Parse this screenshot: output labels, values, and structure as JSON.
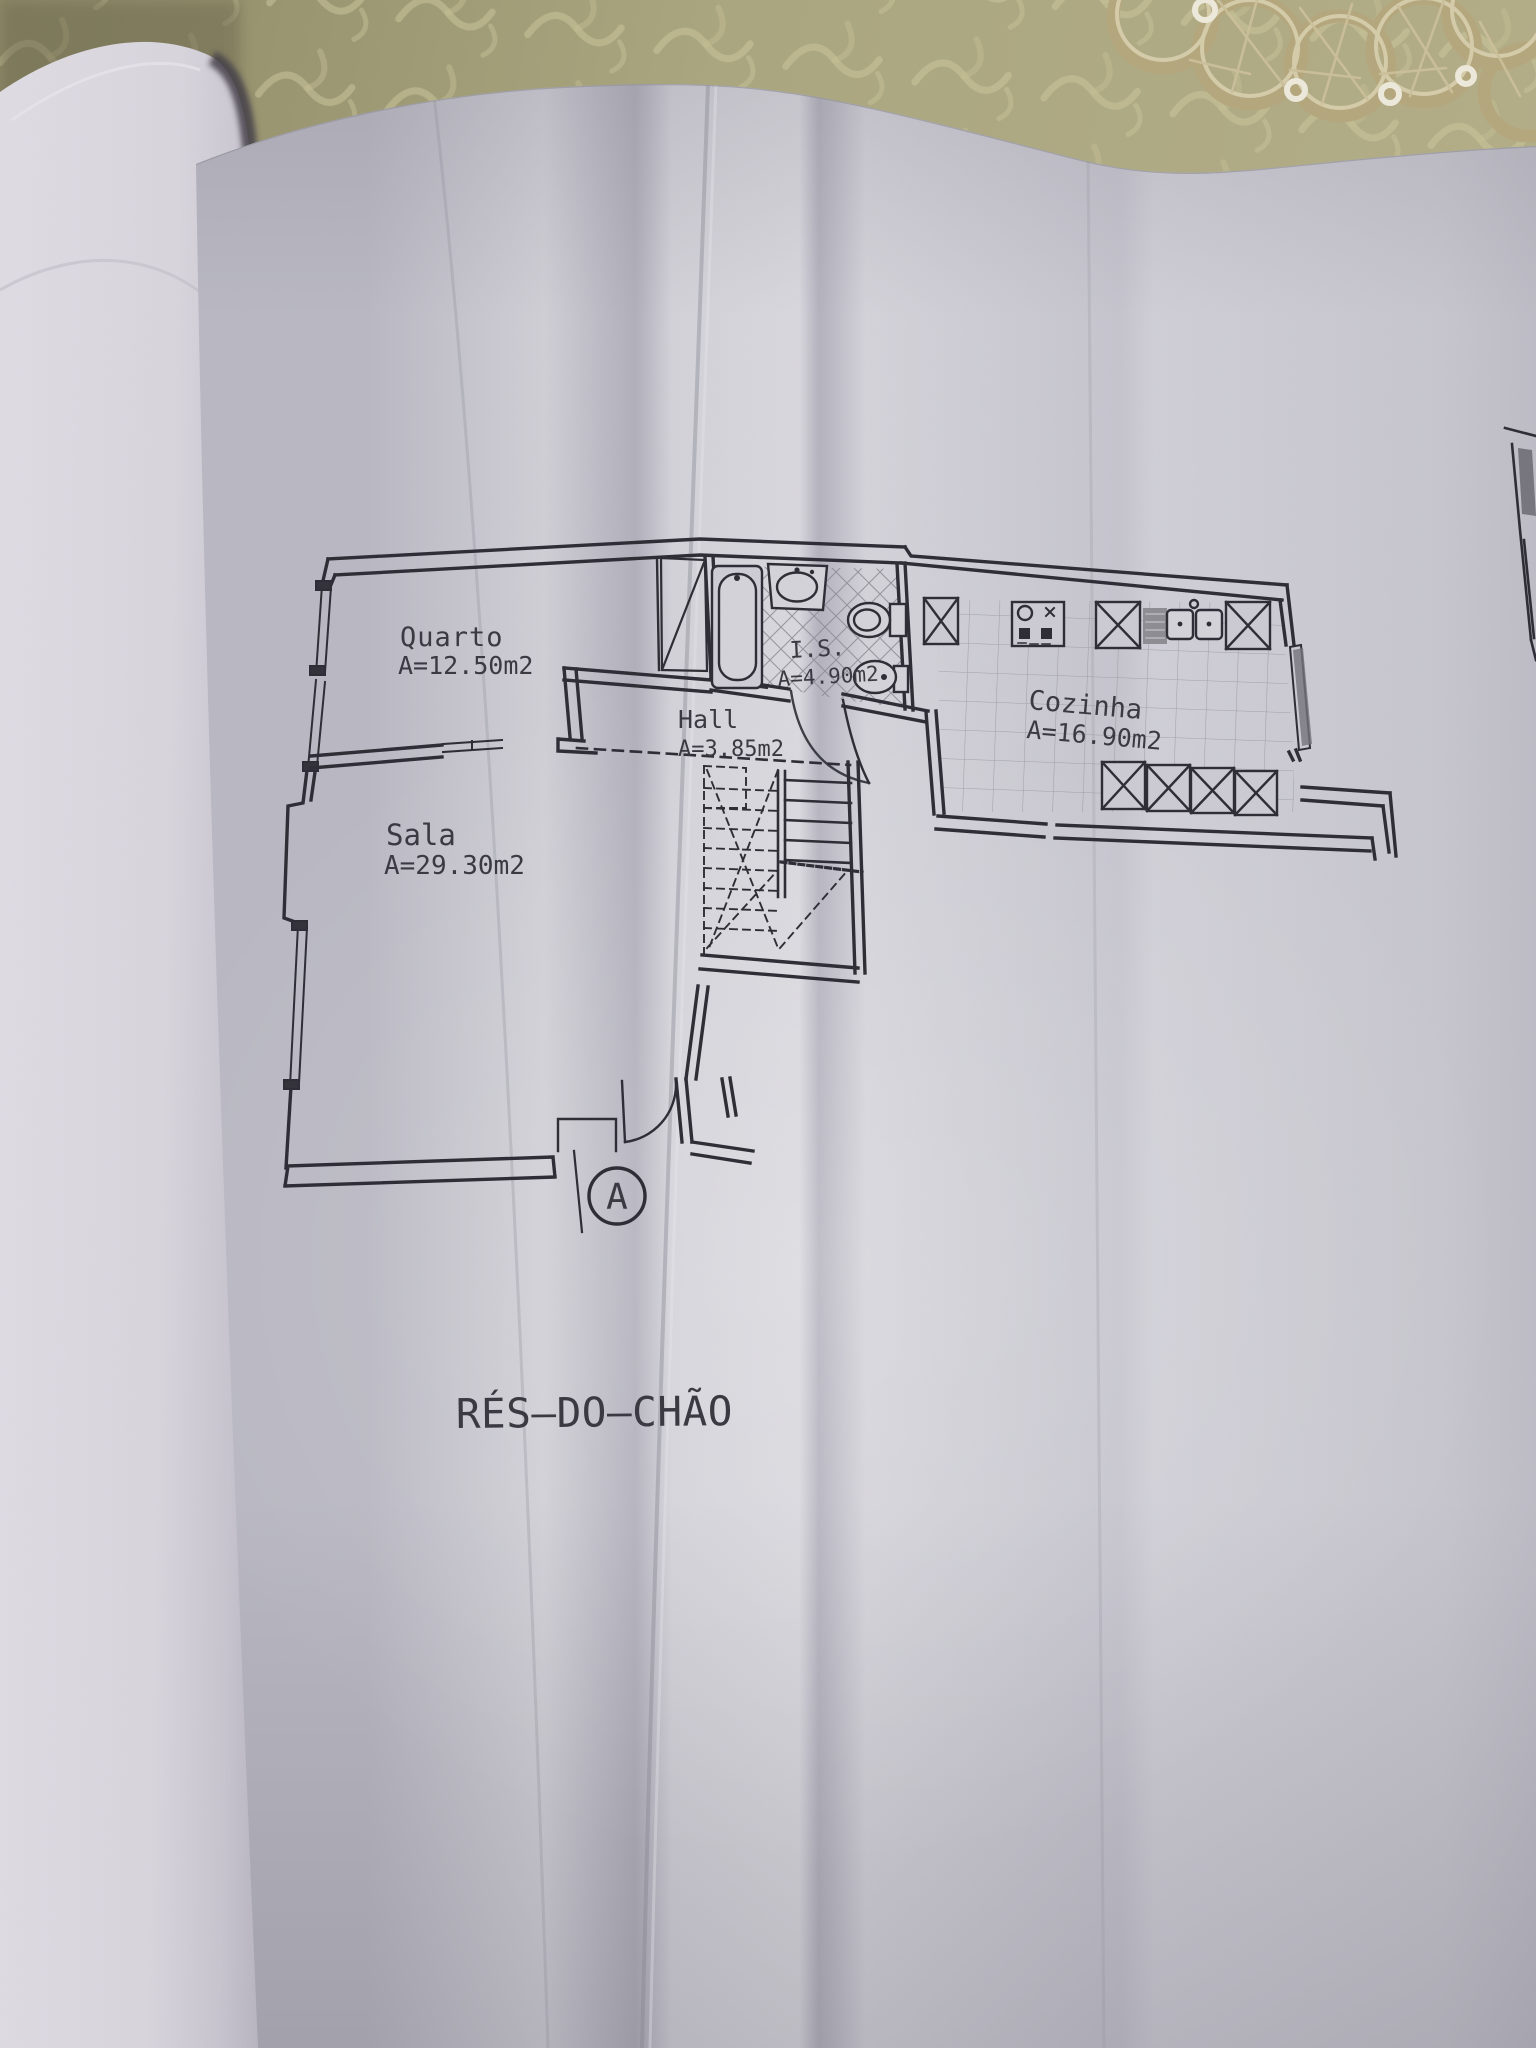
{
  "floor_plan": {
    "title": "RÉS—DO—CHÃO",
    "entrance_marker": "A",
    "rooms": [
      {
        "name": "Quarto",
        "area": "A=12.50m2"
      },
      {
        "name": "I.S.",
        "area": "A=4.90m2"
      },
      {
        "name": "Hall",
        "area": "A=3.85m2"
      },
      {
        "name": "Cozinha",
        "area": "A=16.90m2"
      },
      {
        "name": "Sala",
        "area": "A=29.30m2"
      }
    ],
    "colors": {
      "paper": "#c8c7cf",
      "ink": "#2e2d35",
      "tablecloth": "#a5a17b",
      "lace": "#b8ab84",
      "left_page": "#d9d6de"
    }
  }
}
